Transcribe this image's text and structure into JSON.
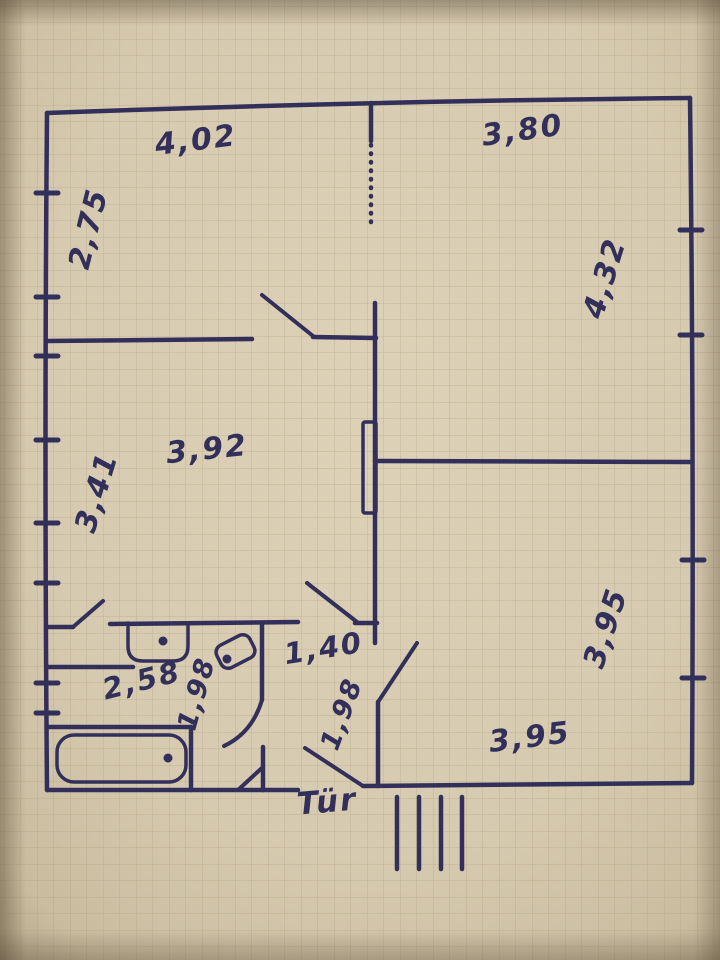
{
  "plan": {
    "colors": {
      "ink": "#32305a",
      "paper": "#d7cbb1",
      "paper_edge": "#a2947a",
      "grid": "#a5946f"
    },
    "labels": [
      {
        "name": "dim-top-left-room-width",
        "text": "4,02",
        "x": 197,
        "y": 150,
        "rot": -7,
        "size": 30
      },
      {
        "name": "dim-top-right-room-width",
        "text": "3,80",
        "x": 524,
        "y": 140,
        "rot": -8,
        "size": 30
      },
      {
        "name": "dim-top-left-room-height",
        "text": "2,75",
        "x": 98,
        "y": 231,
        "rot": -76,
        "size": 30
      },
      {
        "name": "dim-top-right-room-height",
        "text": "4,32",
        "x": 614,
        "y": 281,
        "rot": -73,
        "size": 30
      },
      {
        "name": "dim-middle-room-width",
        "text": "3,92",
        "x": 208,
        "y": 459,
        "rot": -6,
        "size": 30
      },
      {
        "name": "dim-middle-room-height",
        "text": "3,41",
        "x": 106,
        "y": 495,
        "rot": -73,
        "size": 30
      },
      {
        "name": "dim-bottom-right-room-height",
        "text": "3,95",
        "x": 615,
        "y": 631,
        "rot": -72,
        "size": 30
      },
      {
        "name": "dim-bottom-right-room-width",
        "text": "3,95",
        "x": 531,
        "y": 747,
        "rot": -7,
        "size": 30
      },
      {
        "name": "dim-hallway-width",
        "text": "1,40",
        "x": 325,
        "y": 658,
        "rot": -9,
        "size": 29
      },
      {
        "name": "dim-bathroom-width",
        "text": "2,58",
        "x": 144,
        "y": 690,
        "rot": -14,
        "size": 29
      },
      {
        "name": "dim-bathroom-depth",
        "text": "1,98",
        "x": 205,
        "y": 696,
        "rot": -74,
        "size": 27
      },
      {
        "name": "dim-hallway-depth",
        "text": "1,98",
        "x": 350,
        "y": 717,
        "rot": -70,
        "size": 27
      },
      {
        "name": "door-label",
        "text": "Tür",
        "x": 328,
        "y": 812,
        "rot": -5,
        "size": 31
      }
    ],
    "walls": [
      {
        "name": "wall-outer-top",
        "d": "M47,113 Q370,101 690,98"
      },
      {
        "name": "wall-outer-left",
        "d": "M47,113 Q44,450 47,790"
      },
      {
        "name": "wall-outer-right",
        "d": "M690,98 Q694,440 692,783"
      },
      {
        "name": "wall-outer-bottom-right",
        "x1": 363,
        "y1": 786,
        "x2": 692,
        "y2": 783
      },
      {
        "name": "wall-outer-bottom-left",
        "x1": 47,
        "y1": 790,
        "x2": 298,
        "y2": 790
      },
      {
        "name": "wall-top-rooms-divider-a",
        "x1": 47,
        "y1": 341,
        "x2": 252,
        "y2": 339
      },
      {
        "name": "wall-top-rooms-divider-b",
        "x1": 313,
        "y1": 337,
        "x2": 376,
        "y2": 338
      },
      {
        "name": "wall-center-stub-top",
        "x1": 371,
        "y1": 103,
        "x2": 371,
        "y2": 141
      },
      {
        "name": "wall-center-upper",
        "x1": 375,
        "y1": 303,
        "x2": 375,
        "y2": 643
      },
      {
        "name": "wall-center-lower",
        "x1": 378,
        "y1": 702,
        "x2": 378,
        "y2": 786
      },
      {
        "name": "wall-right-room-top",
        "x1": 375,
        "y1": 461,
        "x2": 690,
        "y2": 462
      },
      {
        "name": "wall-bathroom-top-stub-left",
        "x1": 47,
        "y1": 627,
        "x2": 73,
        "y2": 627
      },
      {
        "name": "wall-bathroom-top",
        "x1": 110,
        "y1": 624,
        "x2": 298,
        "y2": 622
      },
      {
        "name": "wall-bathroom-top-stub-right",
        "x1": 355,
        "y1": 623,
        "x2": 377,
        "y2": 623
      },
      {
        "name": "wall-bathroom-inner",
        "x1": 47,
        "y1": 667,
        "x2": 133,
        "y2": 667
      },
      {
        "name": "wall-bathroom-right-upper",
        "x1": 262,
        "y1": 623,
        "x2": 262,
        "y2": 700
      },
      {
        "name": "wall-bathroom-right-lower",
        "x1": 263,
        "y1": 747,
        "x2": 263,
        "y2": 790
      },
      {
        "name": "wall-bathtub-niche-top",
        "x1": 47,
        "y1": 727,
        "x2": 191,
        "y2": 727
      },
      {
        "name": "wall-bathtub-niche-right",
        "x1": 191,
        "y1": 727,
        "x2": 191,
        "y2": 790
      }
    ],
    "door_leaves": [
      {
        "name": "door-leaf-top-left-room",
        "x1": 262,
        "y1": 295,
        "x2": 313,
        "y2": 336
      },
      {
        "name": "door-leaf-middle-room",
        "x1": 307,
        "y1": 583,
        "x2": 357,
        "y2": 622
      },
      {
        "name": "door-leaf-wc",
        "x1": 73,
        "y1": 627,
        "x2": 103,
        "y2": 601
      },
      {
        "name": "door-swing-bathroom",
        "d": "M262,700 Q252,733 224,746"
      },
      {
        "name": "door-leaf-bathroom",
        "x1": 238,
        "y1": 790,
        "x2": 263,
        "y2": 767
      },
      {
        "name": "door-leaf-bottom-right-room",
        "x1": 378,
        "y1": 702,
        "x2": 417,
        "y2": 643
      },
      {
        "name": "door-leaf-entrance",
        "x1": 305,
        "y1": 748,
        "x2": 363,
        "y2": 786
      }
    ],
    "dotted_partition": {
      "name": "dotted-partition",
      "x": 371,
      "y1": 145,
      "y2": 226
    },
    "window_ticks": [
      {
        "x": 47,
        "y": 193
      },
      {
        "x": 47,
        "y": 297
      },
      {
        "x": 47,
        "y": 356
      },
      {
        "x": 47,
        "y": 440
      },
      {
        "x": 47,
        "y": 523
      },
      {
        "x": 47,
        "y": 583
      },
      {
        "x": 47,
        "y": 683
      },
      {
        "x": 47,
        "y": 713
      },
      {
        "x": 691,
        "y": 230
      },
      {
        "x": 691,
        "y": 335
      },
      {
        "x": 693,
        "y": 560
      },
      {
        "x": 693,
        "y": 678
      }
    ],
    "stair_hatch": {
      "name": "entrance-steps-hatch",
      "xs": [
        397,
        419,
        441,
        462
      ],
      "y1": 797,
      "y2": 869
    },
    "fixtures": {
      "radiator": {
        "name": "duct-niche",
        "x": 363,
        "y": 422,
        "w": 13,
        "h": 91
      },
      "sink": {
        "name": "sink",
        "d": "M128,623 L128,646 Q128,661 143,661 L173,661 Q188,661 188,646 L188,623"
      },
      "toilet": {
        "name": "toilet",
        "x": 217,
        "y": 639,
        "w": 37,
        "h": 25,
        "rx": 8,
        "rot": -27,
        "cx": 235.5,
        "cy": 651.5
      },
      "bathtub": {
        "name": "bathtub",
        "x": 57,
        "y": 735,
        "w": 129,
        "h": 47,
        "rx": 17
      }
    },
    "drain_dots": [
      {
        "name": "sink-drain-dot",
        "x": 163,
        "y": 641
      },
      {
        "name": "toilet-drain-dot",
        "x": 227,
        "y": 659
      },
      {
        "name": "bathtub-drain-dot",
        "x": 168,
        "y": 758
      }
    ]
  }
}
